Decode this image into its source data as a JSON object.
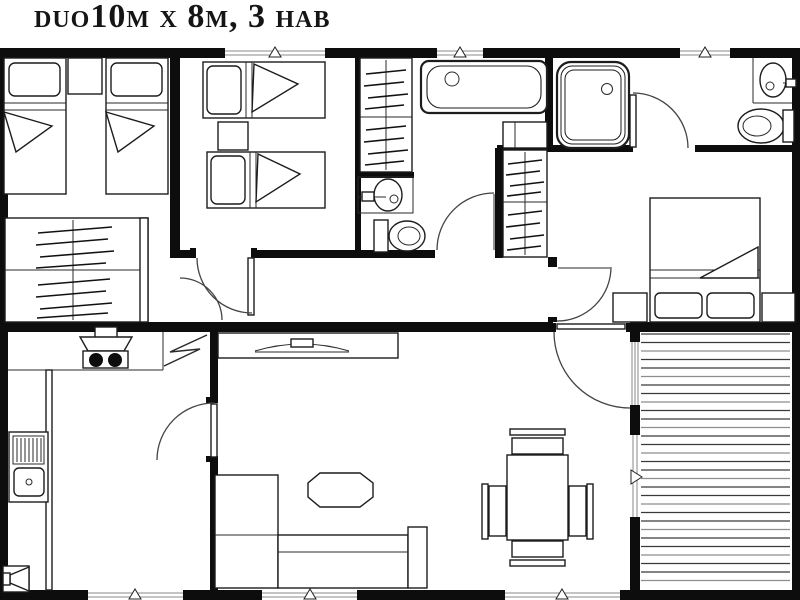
{
  "title": "duo10m x 8m, 3 hab",
  "floor_plan": {
    "model": "duo",
    "dimensions": "10m x 8m",
    "bedrooms_label": "3 hab",
    "rooms": [
      {
        "name": "bedroom-1",
        "furniture": [
          "single bed",
          "single bed",
          "nightstand",
          "double wardrobe"
        ]
      },
      {
        "name": "bedroom-2",
        "furniture": [
          "single bed",
          "single bed",
          "nightstand"
        ]
      },
      {
        "name": "bathroom-1",
        "fixtures": [
          "bathtub",
          "washbasin",
          "toilet",
          "wardrobe column"
        ]
      },
      {
        "name": "bathroom-2",
        "fixtures": [
          "shower tray",
          "washbasin",
          "toilet"
        ]
      },
      {
        "name": "master-bedroom",
        "furniture": [
          "double bed",
          "nightstand",
          "nightstand",
          "wardrobe column"
        ]
      },
      {
        "name": "hallway",
        "furniture": []
      },
      {
        "name": "kitchen",
        "fixtures": [
          "extractor hood",
          "two-burner cooktop",
          "refrigerator",
          "sink with drainer",
          "corner unit"
        ]
      },
      {
        "name": "living-dining",
        "furniture": [
          "tv cabinet",
          "curved tv",
          "octagonal coffee table",
          "l-shaped sofa",
          "dining table",
          "chair",
          "chair",
          "chair",
          "chair"
        ]
      },
      {
        "name": "terrace",
        "features": [
          "wood decking",
          "sliding entrance door",
          "window"
        ]
      }
    ],
    "window_count": 7,
    "door_count": 8
  },
  "colors": {
    "ink": "#0d0d0d",
    "paper": "#ffffff",
    "deck_line": "#555555"
  }
}
